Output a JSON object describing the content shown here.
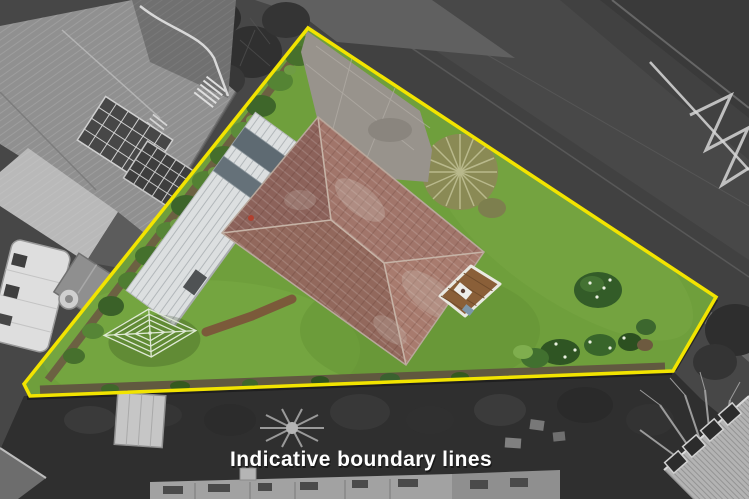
{
  "caption": {
    "text": "Indicative boundary lines"
  },
  "colors": {
    "boundary_line": "#F2E400",
    "lawn": "#6F9F3C",
    "house_roof": "#9B7064",
    "garage_roof": "#DCDFE0",
    "driveway_concrete": "#98938C",
    "deck_wood": "#8A5F38",
    "road_asphalt": "#414141",
    "surroundings_base": "#474747",
    "caption_text": "#FFFFFF"
  },
  "scene": {
    "description": "Aerial drone photo of a triangular residential section outlined with yellow indicative boundary lines; the property is shown in colour while the surrounding houses, road and trees are desaturated",
    "elements": [
      "boundary-line",
      "lawn",
      "main-house-hip-roof",
      "garage-roof",
      "concrete-driveway",
      "timber-deck",
      "rotary-clothesline",
      "timber-path",
      "hedge",
      "garden-beds",
      "tussock-bush",
      "road",
      "road-markings",
      "neighbour-house",
      "caravan",
      "garden-shed",
      "trees"
    ]
  }
}
